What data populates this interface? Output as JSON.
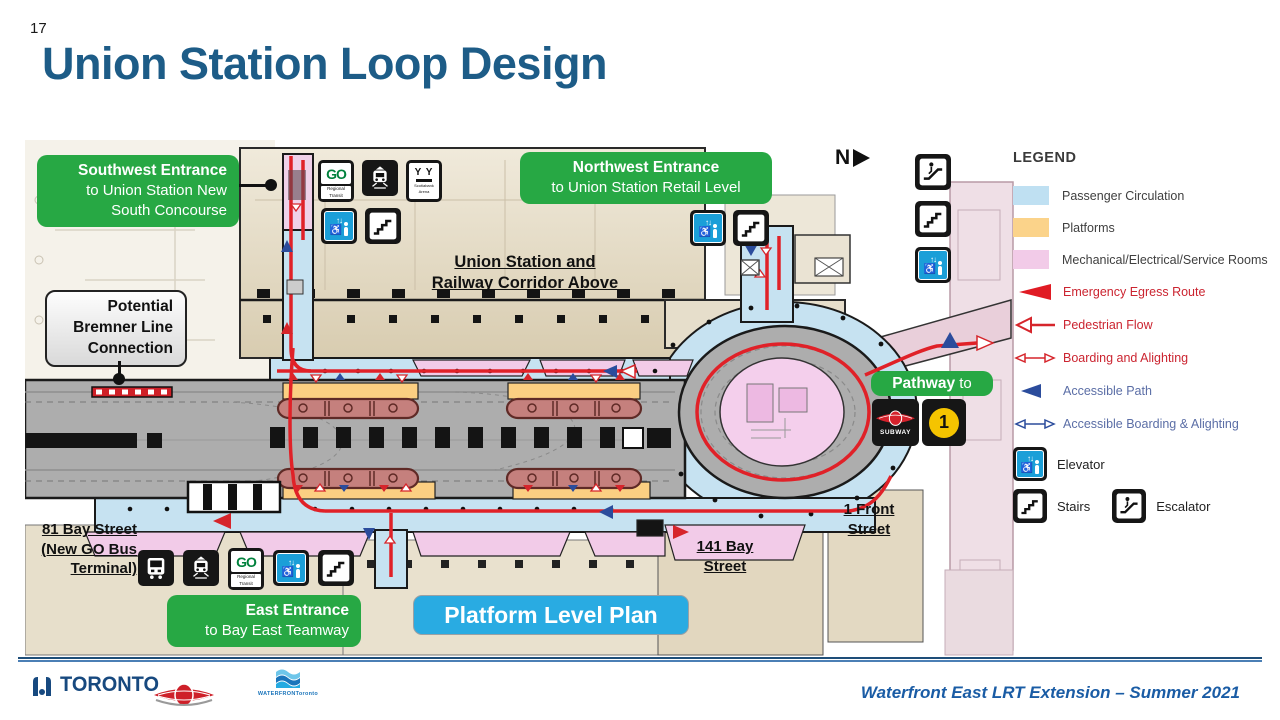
{
  "slide": {
    "page_number": "17",
    "title": "Union Station Loop Design"
  },
  "plan": {
    "callouts": {
      "southwest": {
        "bold": "Southwest Entrance",
        "line2": "to Union Station New",
        "line3": "South Concourse"
      },
      "northwest": {
        "bold": "Northwest Entrance",
        "line2": "to Union Station Retail Level"
      },
      "east": {
        "bold": "East Entrance",
        "line2": "to Bay East Teamway"
      },
      "pathway": {
        "bold": "Pathway",
        "rest": " to"
      },
      "bremner": {
        "line1": "Potential",
        "line2": "Bremner Line",
        "line3": "Connection"
      }
    },
    "labels": {
      "corridor_line1": "Union Station and",
      "corridor_line2": "Railway Corridor Above",
      "bay81_line1": "81 Bay Street",
      "bay81_line2": "(New GO Bus",
      "bay81_line3": "Terminal)",
      "bay141_line1": "141 Bay",
      "bay141_line2": "Street",
      "front1_line1": "1 Front",
      "front1_line2": "Street",
      "platform_level": "Platform Level Plan",
      "north": "N"
    },
    "icons": {
      "go_glyph": "GO",
      "go_sub": "Regional Transit",
      "arena_glyph": "Y Y",
      "arena_sub1": "Scotiabank",
      "arena_sub2": "Arena",
      "elevator_glyph": "↑↓",
      "wheelchair_glyph": "♿",
      "subway_label": "SUBWAY",
      "line1_label": "1"
    },
    "colors": {
      "passenger_circulation": "#C6E2F1",
      "platforms": "#FBCF82",
      "mechanical_rooms": "#F2CBE8",
      "emergency_red": "#E02128",
      "accessible_blue": "#2B4C9C",
      "callout_green": "#27A844",
      "platform_plan_blue": "#29ABE2"
    }
  },
  "legend": {
    "title": "LEGEND",
    "items": [
      {
        "label": "Passenger Circulation",
        "type": "swatch",
        "color": "#BFE0F2"
      },
      {
        "label": "Platforms",
        "type": "swatch",
        "color": "#FBD38A"
      },
      {
        "label": "Mechanical/Electrical/Service Rooms",
        "type": "swatch",
        "color": "#F2CBE8"
      },
      {
        "label": "Emergency Egress Route",
        "type": "arrow-solid",
        "color": "#E01B24"
      },
      {
        "label": "Pedestrian Flow",
        "type": "arrow-open",
        "color": "#D6252B"
      },
      {
        "label": "Boarding and Alighting",
        "type": "arrow-double",
        "color": "#D6252B"
      },
      {
        "label": "Accessible Path",
        "type": "arrow-solid",
        "color": "#2B4C9C"
      },
      {
        "label": "Accessible Boarding & Alighting",
        "type": "arrow-double",
        "color": "#2B4C9C"
      }
    ],
    "elevator_label": "Elevator",
    "stairs_label": "Stairs",
    "escalator_label": "Escalator"
  },
  "footer": {
    "toronto_wordmark": "TORONTO",
    "waterfront_brand": "WATERFRONToronto",
    "caption": "Waterfront East LRT Extension – Summer 2021"
  }
}
